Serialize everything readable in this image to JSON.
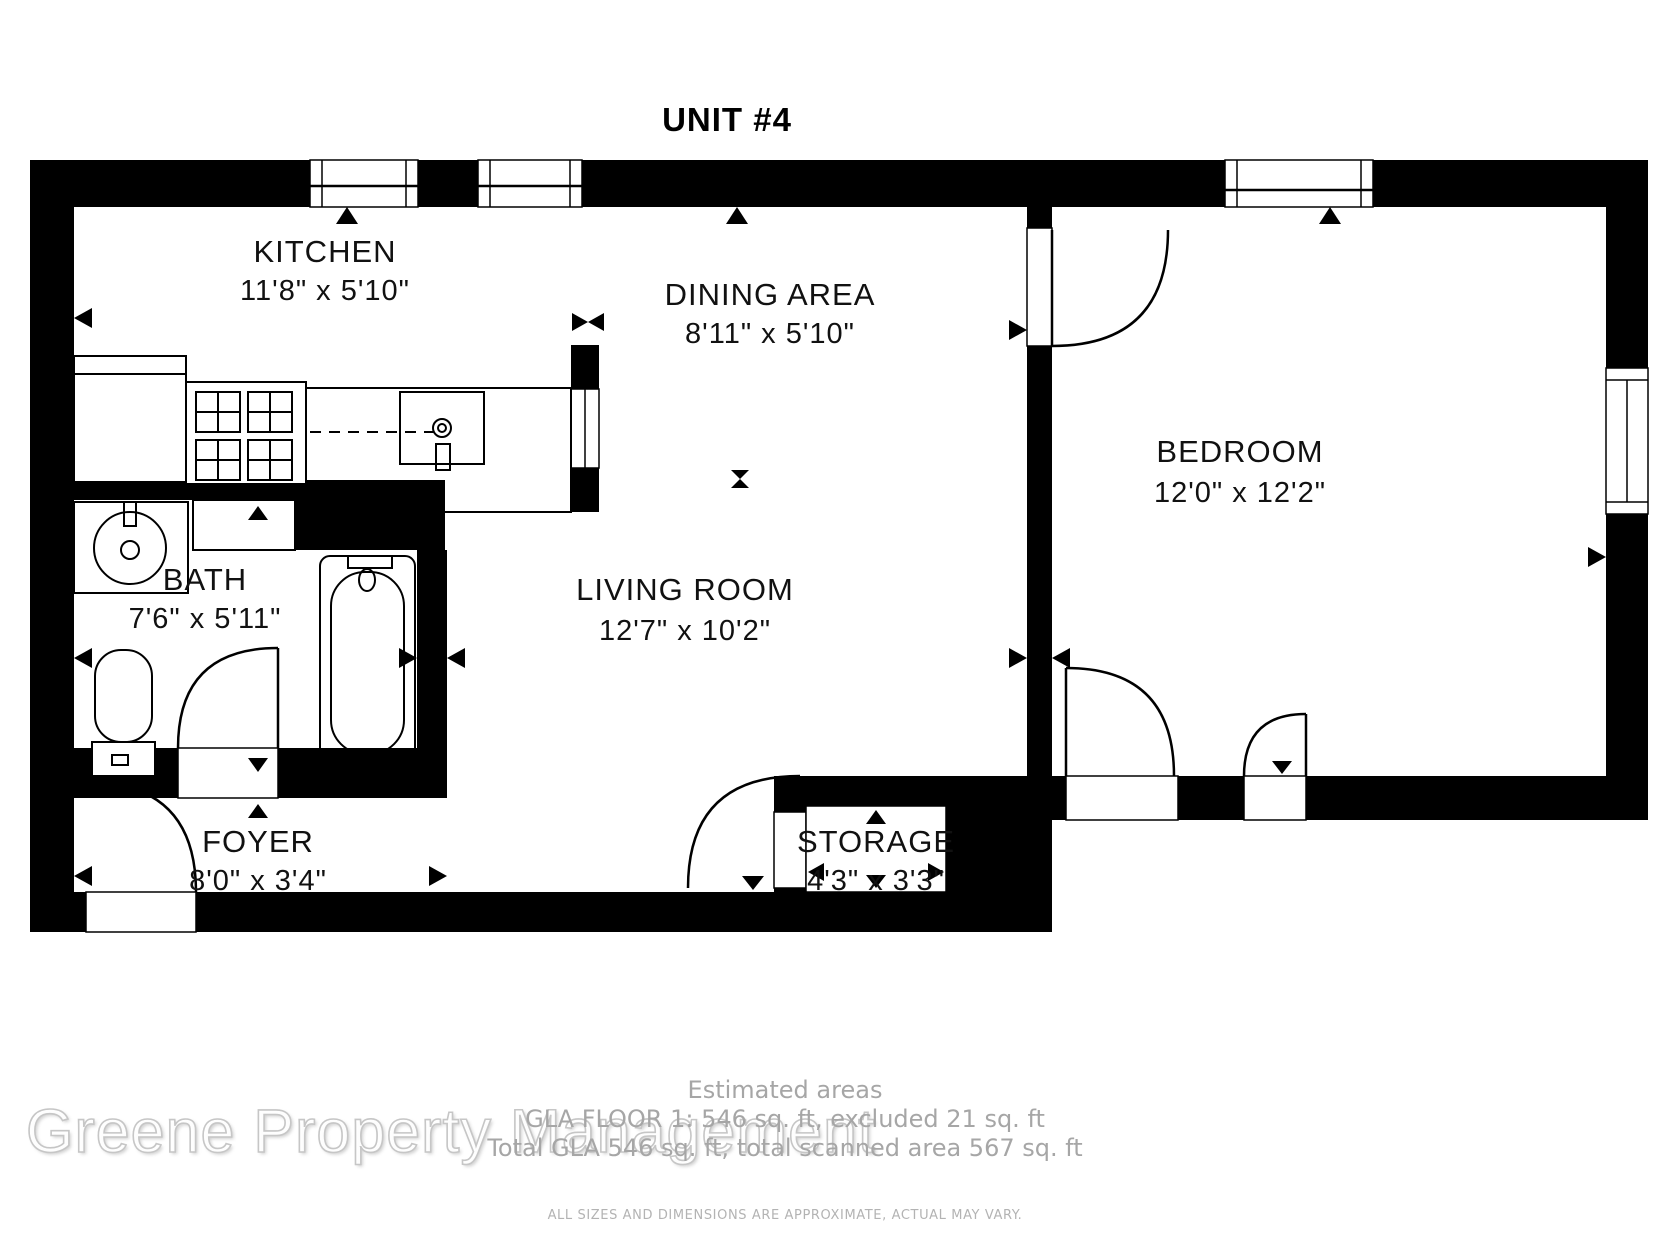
{
  "title": "UNIT #4",
  "rooms": [
    {
      "name": "KITCHEN",
      "dims": "11'8\" x 5'10\""
    },
    {
      "name": "DINING AREA",
      "dims": "8'11\" x 5'10\""
    },
    {
      "name": "BEDROOM",
      "dims": "12'0\" x 12'2\""
    },
    {
      "name": "BATH",
      "dims": "7'6\" x 5'11\""
    },
    {
      "name": "LIVING ROOM",
      "dims": "12'7\" x 10'2\""
    },
    {
      "name": "FOYER",
      "dims": "8'0\" x 3'4\""
    },
    {
      "name": "STORAGE",
      "dims": "4'3\" x 3'3\""
    }
  ],
  "footer": {
    "estimated_label": "Estimated areas",
    "gla_floor": "GLA FLOOR 1: 546 sq. ft, excluded 21 sq. ft",
    "total_gla": "Total GLA 546 sq. ft, total scanned area 567 sq. ft",
    "disclaimer": "ALL SIZES AND DIMENSIONS ARE APPROXIMATE, ACTUAL MAY VARY."
  },
  "watermark": "Greene Property Management",
  "colors": {
    "wall": "#000000",
    "background": "#ffffff",
    "footer_text": "#a6a6a6",
    "watermark_outline": "#c6c6c6"
  }
}
